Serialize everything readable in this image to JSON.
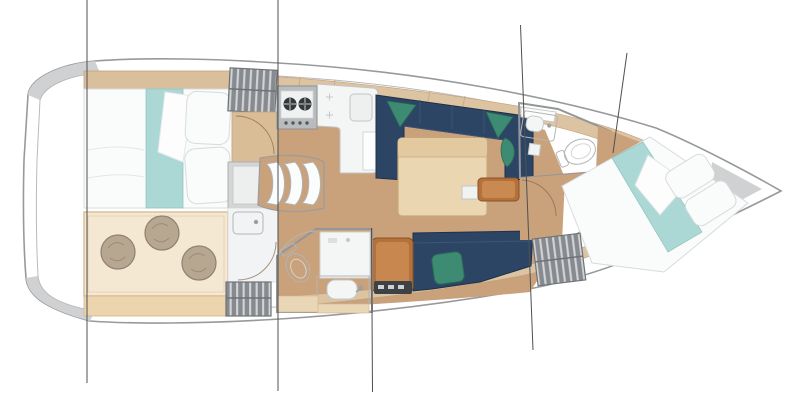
{
  "diagram": {
    "type": "yacht-interior-floor-plan",
    "view": "top-down",
    "orientation": "bow-right",
    "text_labels": []
  },
  "palette": {
    "background": "#ffffff",
    "interior_white": "#fdfdfd",
    "hull_band": "#e6e7e8",
    "hull_corner": "#cfd1d2",
    "hull_outline": "#97999b",
    "deck_inner_line": "#b8babc",
    "deck_wood": "#dcc3a2",
    "deck_wood_edge": "#c2a078",
    "floor_wood": "#c9a17a",
    "floor_arc": "#8a6f52",
    "cabin_floor": "#f4e8d3",
    "cabin_floor_edge": "#d9c09a",
    "cabin_shelf": "#ecd4ae",
    "settee_navy": "#2d4565",
    "settee_navy_edge": "#1e3049",
    "settee_seam": "#3b5679",
    "pillow_green": "#3c8b72",
    "pillow_green_edge": "#2c6b56",
    "table_wood": "#ead6b0",
    "table_top_band": "#e2c9a0",
    "table_edge": "#c9a87b",
    "cabinet_orange": "#b5713a",
    "cabinet_orange_light": "#c98a52",
    "bed_white": "#fafbfb",
    "bed_edge": "#d8dbdc",
    "bed_teal": "#abd8d4",
    "headboard_wood": "#d9bf9b",
    "wardrobe_gray": "#878b90",
    "wardrobe_stripe": "#d2d4d6",
    "pouf": "#b7a791",
    "pouf_edge": "#8f8170",
    "bath_floor": "#e9ebeb",
    "bath_wall": "#94979a",
    "fixture": "#ffffff",
    "fixture_edge": "#b2b5b7",
    "counter_white": "#f4f5f5",
    "counter_edge": "#c2c4c6",
    "stove_gray": "#b9bcbf",
    "burner": "#34383b",
    "equipment": "#3f4245",
    "beige_panel": "#e9d6b6",
    "fridge_gray": "#d3d5d6",
    "bulkhead_dark": "#3b3f43",
    "section_line": "#4f5052"
  },
  "components": [
    "hull",
    "section-lines",
    "aft-cabin-bed",
    "aft-cabin-lounge",
    "poufs",
    "hanging-lockers",
    "galley-stove",
    "galley-counter",
    "companionway-steps",
    "salon-u-settee",
    "salon-table",
    "salon-bottom-settee",
    "nav-cabinet",
    "aft-head-toilet",
    "aft-head-sink",
    "forward-head-toilet",
    "forward-head-sink",
    "forward-cabin-berth"
  ]
}
